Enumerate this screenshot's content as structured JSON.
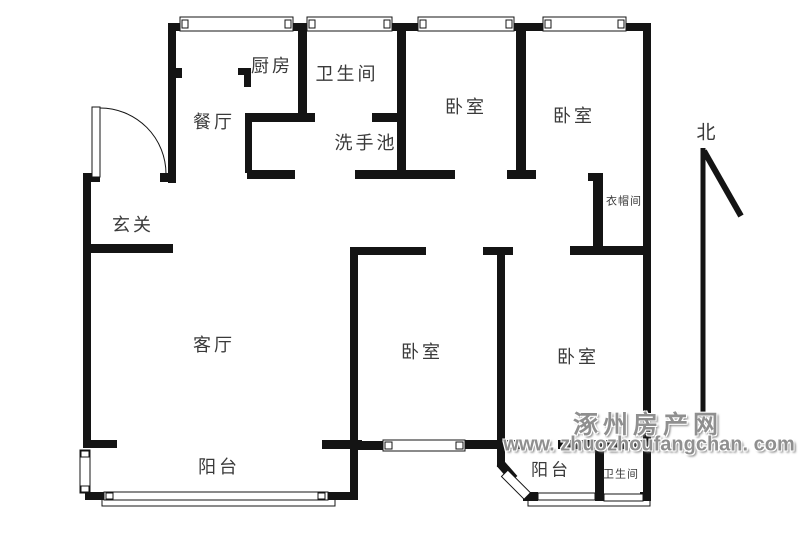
{
  "plan": {
    "rooms": {
      "kitchen": "厨房",
      "bathroom_top": "卫生间",
      "dining": "餐厅",
      "washbasin": "洗手池",
      "entry_hall": "玄关",
      "bedroom_top_left": "卧室",
      "bedroom_top_right": "卧室",
      "cloakroom": "衣帽间",
      "living_room": "客厅",
      "balcony_main": "阳台",
      "bedroom_bottom_middle": "卧室",
      "bedroom_bottom_right": "卧室",
      "balcony_small": "阳台",
      "bathroom_bottom": "卫生间"
    },
    "north_label": "北",
    "colors": {
      "wall": "#141414",
      "background": "#ffffff",
      "watermark": "#8f8f8f"
    }
  },
  "watermark": {
    "line1": "涿州房产网",
    "line2": "www. zhuozhoufangchan. com"
  }
}
